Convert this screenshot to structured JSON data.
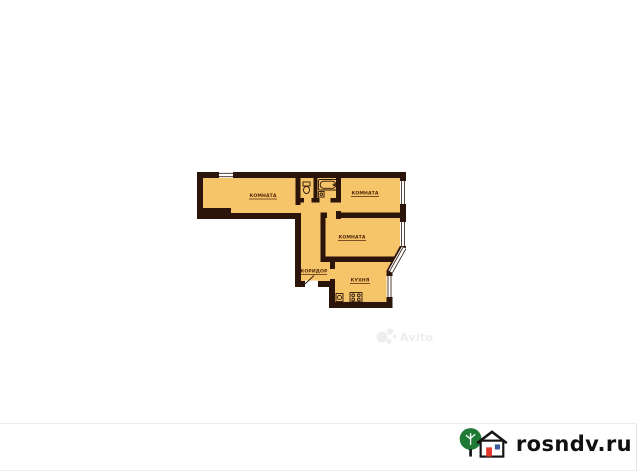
{
  "image": {
    "background_color": "#ffffff",
    "frame_line_color": "#ececec"
  },
  "floor_plan": {
    "fill_color": "#f7c569",
    "wall_color": "#2b1409",
    "label_color": "#53290b",
    "window_glazing_color": "#ffffff",
    "rooms": [
      {
        "name": "room-left",
        "label": "КОМНАТА"
      },
      {
        "name": "room-top-right",
        "label": "КОМНАТА"
      },
      {
        "name": "room-middle-right",
        "label": "КОМНАТА"
      },
      {
        "name": "corridor",
        "label": "КОРИДОР"
      },
      {
        "name": "kitchen",
        "label": "КУХНЯ"
      }
    ],
    "fixtures": [
      "toilet-icon",
      "bathtub-icon",
      "sink-icon",
      "kitchen-sink-icon",
      "stove-icon"
    ]
  },
  "watermark": {
    "text": "Avito",
    "color": "#e2e2e2"
  },
  "site_logo": {
    "text": "rosndv.ru",
    "text_color": "#111111",
    "tree_color": "#1f7a35",
    "house_outline_color": "#141414",
    "door_color": "#e0392e",
    "window_color": "#3a5ba0"
  }
}
